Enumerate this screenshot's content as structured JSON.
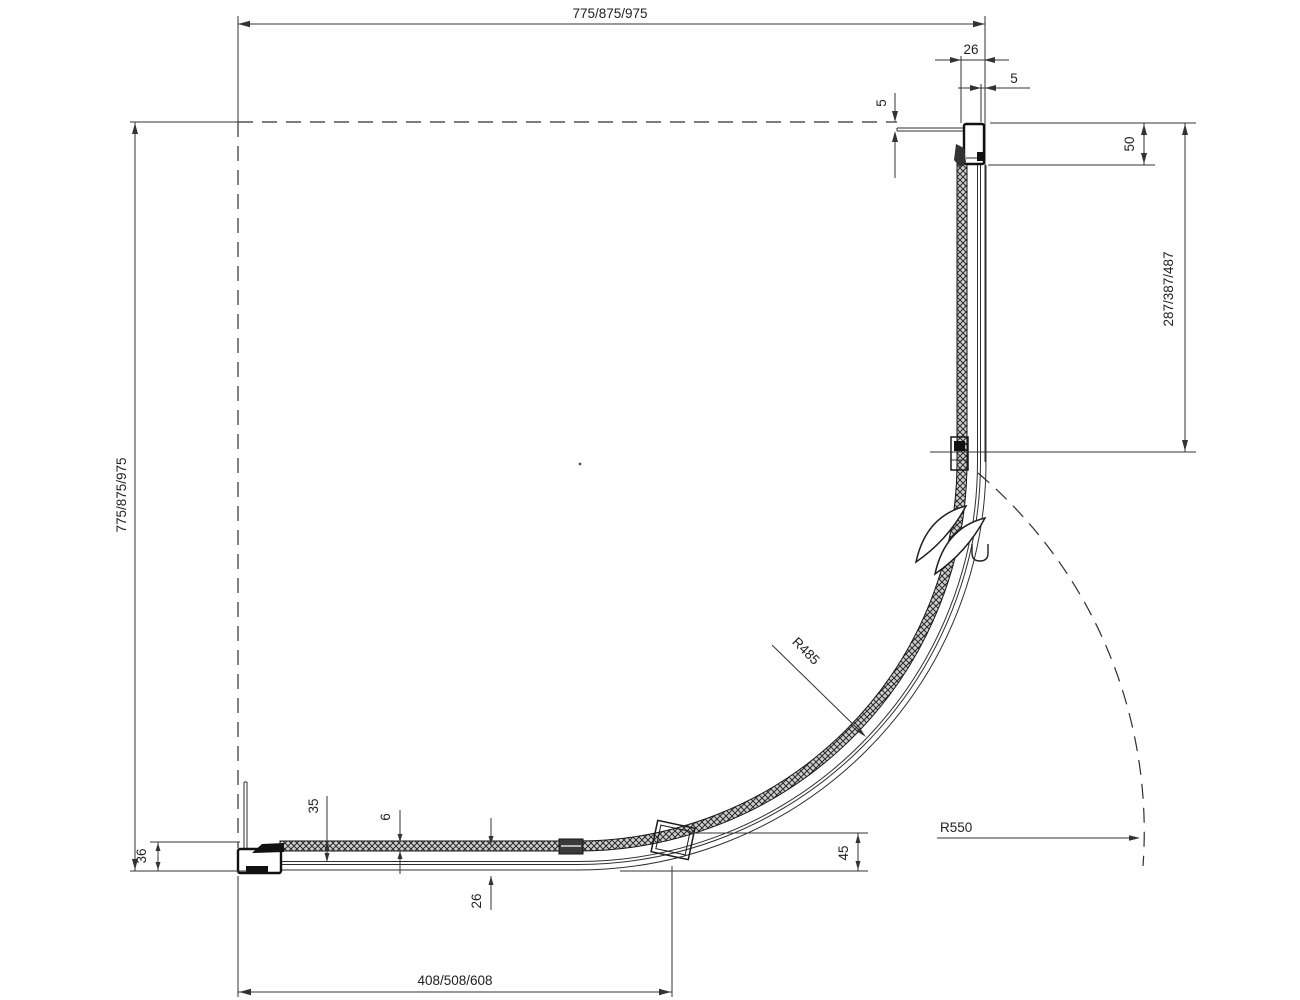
{
  "drawing": {
    "dimensions": {
      "width_top": "775/875/975",
      "height_left": "775/875/975",
      "fixed_panel_right": "287/387/487",
      "bottom_segment": "408/508/608",
      "profile_width": "26",
      "profile_edge_gap": "5",
      "wall_gap": "5",
      "profile_height": "50",
      "wall_profile_depth": "36",
      "rail_height": "35",
      "glass_thickness": "6",
      "track_depth": "26",
      "door_edge_height": "45"
    },
    "radii": {
      "glass_radius": "R485",
      "outer_radius": "R550"
    },
    "colors": {
      "line": "#2f2f2f",
      "glass_fill": "#cfcfcf",
      "background": "#ffffff"
    }
  }
}
